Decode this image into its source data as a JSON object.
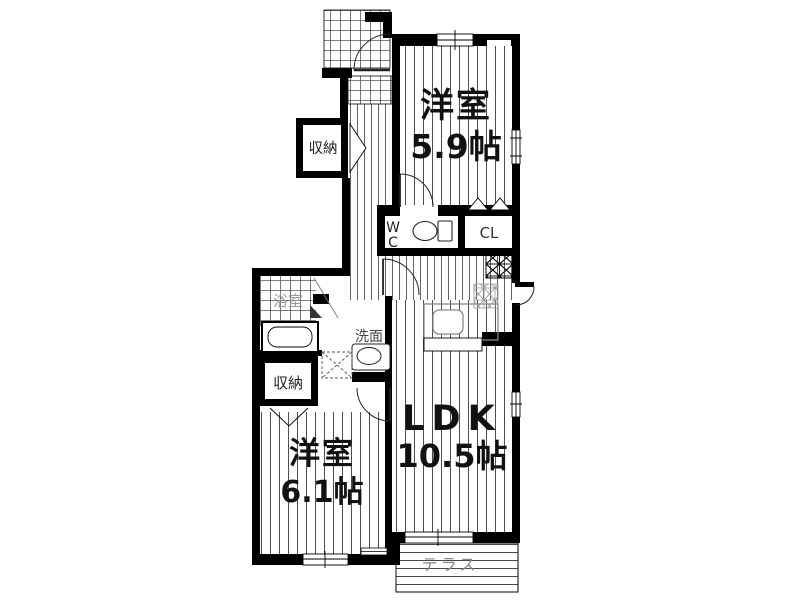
{
  "plan": {
    "title": "floor-plan",
    "rooms": {
      "bedroom_a": {
        "name": "洋室",
        "size": "5.9帖"
      },
      "bedroom_b": {
        "name": "洋室",
        "size": "6.1帖"
      },
      "ldk": {
        "name": "LDK",
        "size": "10.5帖"
      },
      "bath": {
        "label": "浴室"
      },
      "washstand": {
        "label": "洗面"
      },
      "wc": {
        "label": "WC",
        "line1": "W",
        "line2": "C"
      },
      "closet": {
        "label": "CL"
      },
      "storage_upper": {
        "label": "収納"
      },
      "storage_lower": {
        "label": "収納"
      },
      "terrace": {
        "label": "テラス"
      }
    },
    "colors": {
      "wall": "#000000",
      "floor_line": "#3a3a3a",
      "bath_label": "#999999",
      "washstand_label": "#444444",
      "terrace_label": "#888888"
    }
  }
}
